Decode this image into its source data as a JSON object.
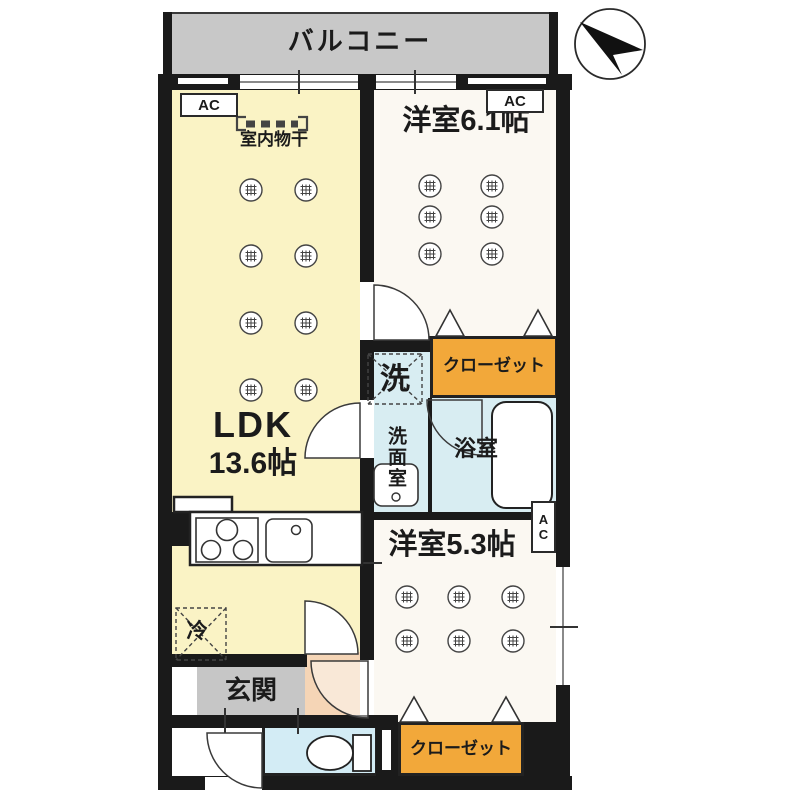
{
  "plan": {
    "balcony_label": "バルコニー",
    "ldk_name": "LDK",
    "ldk_size": "13.6帖",
    "bedroom1_label": "洋室6.1帖",
    "bedroom2_label": "洋室5.3帖",
    "bathroom_label": "浴室",
    "washroom_label": "洗面室",
    "entrance_label": "玄関",
    "closet_top_label": "クローゼット",
    "closet_bottom_label": "クローゼット",
    "washer_label": "洗",
    "fridge_label": "冷",
    "indoor_laundry_label": "室内物干",
    "ac_label": "AC",
    "colors": {
      "ldk_floor": "#faf3c5",
      "bedroom_floor": "#fbf8f2",
      "closet": "#f2a83a",
      "wet_area": "#d8edf2",
      "hall": "#f5d5b6",
      "balcony": "#c8c8c8",
      "entrance": "#c6c6c6",
      "wall": "#1a1a1a"
    }
  }
}
